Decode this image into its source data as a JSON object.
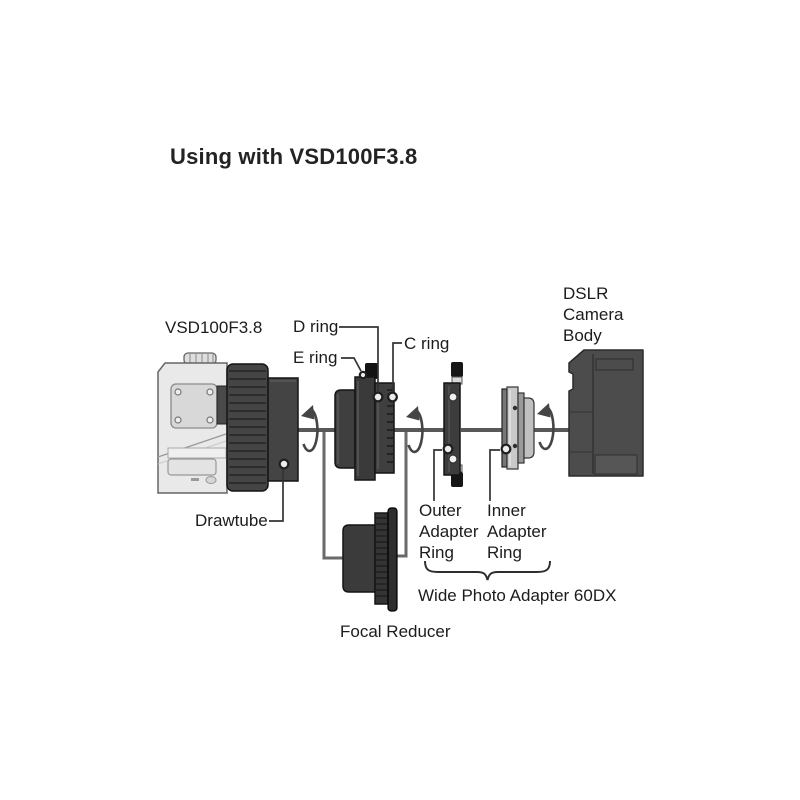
{
  "title": "Using with VSD100F3.8",
  "labels": {
    "telescope": "VSD100F3.8",
    "d_ring": "D ring",
    "e_ring": "E ring",
    "c_ring": "C ring",
    "drawtube": "Drawtube",
    "dslr": [
      "DSLR",
      "Camera",
      "Body"
    ],
    "outer_adapter": [
      "Outer",
      "Adapter",
      "Ring"
    ],
    "inner_adapter": [
      "Inner",
      "Adapter",
      "Ring"
    ],
    "wide_photo_adapter": "Wide Photo Adapter 60DX",
    "focal_reducer": "Focal Reducer"
  },
  "colors": {
    "background": "#ffffff",
    "text": "#1c1c1c",
    "dark_component": "#3f3f3f",
    "camera_body": "#4c4c4c",
    "light_body": "#e9e9e9",
    "axis_line": "#585858"
  }
}
